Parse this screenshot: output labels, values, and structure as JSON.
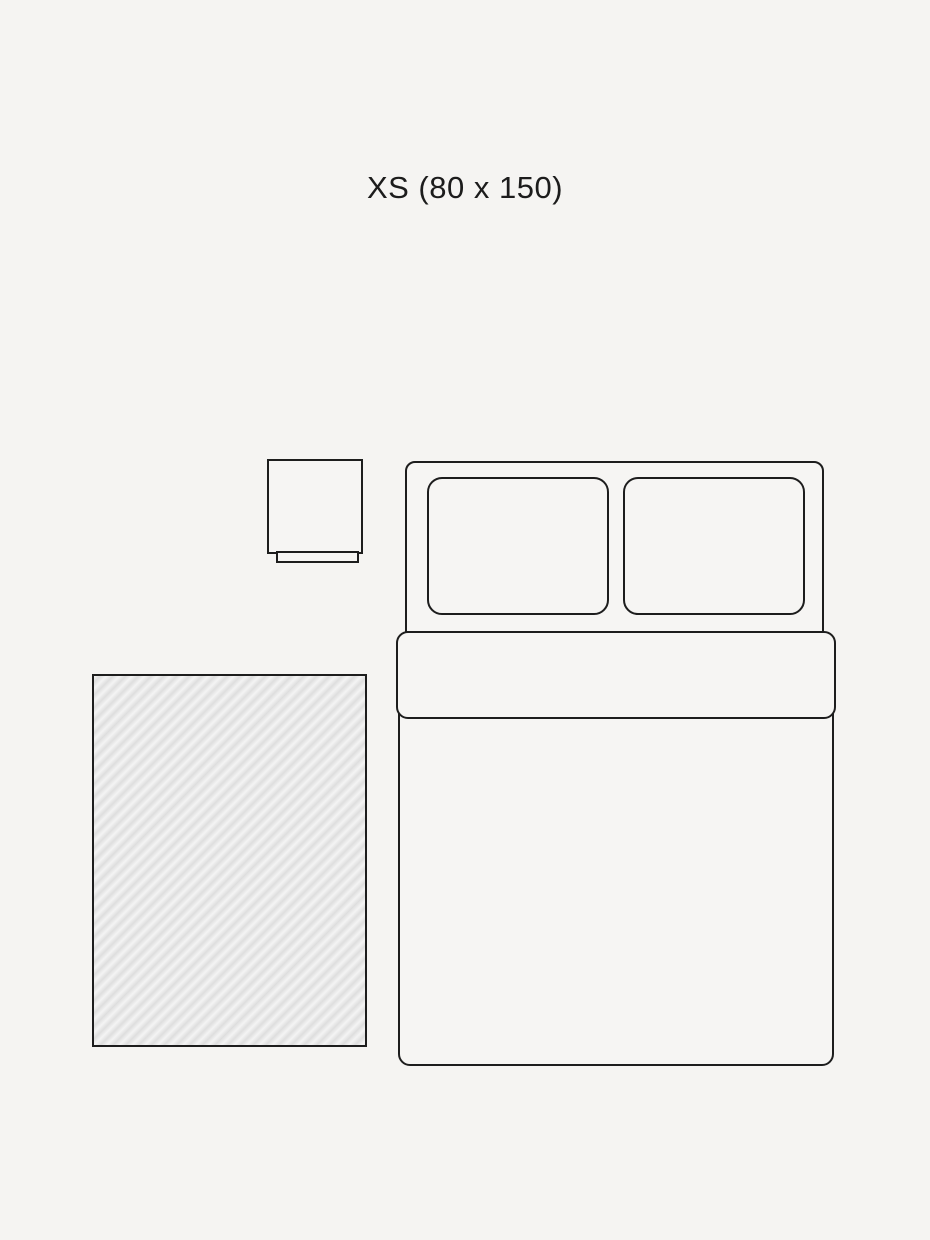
{
  "page": {
    "title": "XS (80 x 150)"
  },
  "colors": {
    "background": "#f5f4f2",
    "stroke": "#1d1d1d",
    "text": "#1c1c1c",
    "rug_hatch_dark": "#dedede",
    "rug_hatch_light": "#f4f4f4"
  },
  "diagram": {
    "description": "rug size guide illustration",
    "size_label": "XS (80 x 150)",
    "rug_width_cm": 80,
    "rug_length_cm": 150,
    "items": [
      {
        "name": "rug",
        "pattern": "diagonal-hatch"
      },
      {
        "name": "nightstand"
      },
      {
        "name": "bed"
      },
      {
        "name": "pillow-left"
      },
      {
        "name": "pillow-right"
      },
      {
        "name": "duvet-fold"
      }
    ]
  }
}
